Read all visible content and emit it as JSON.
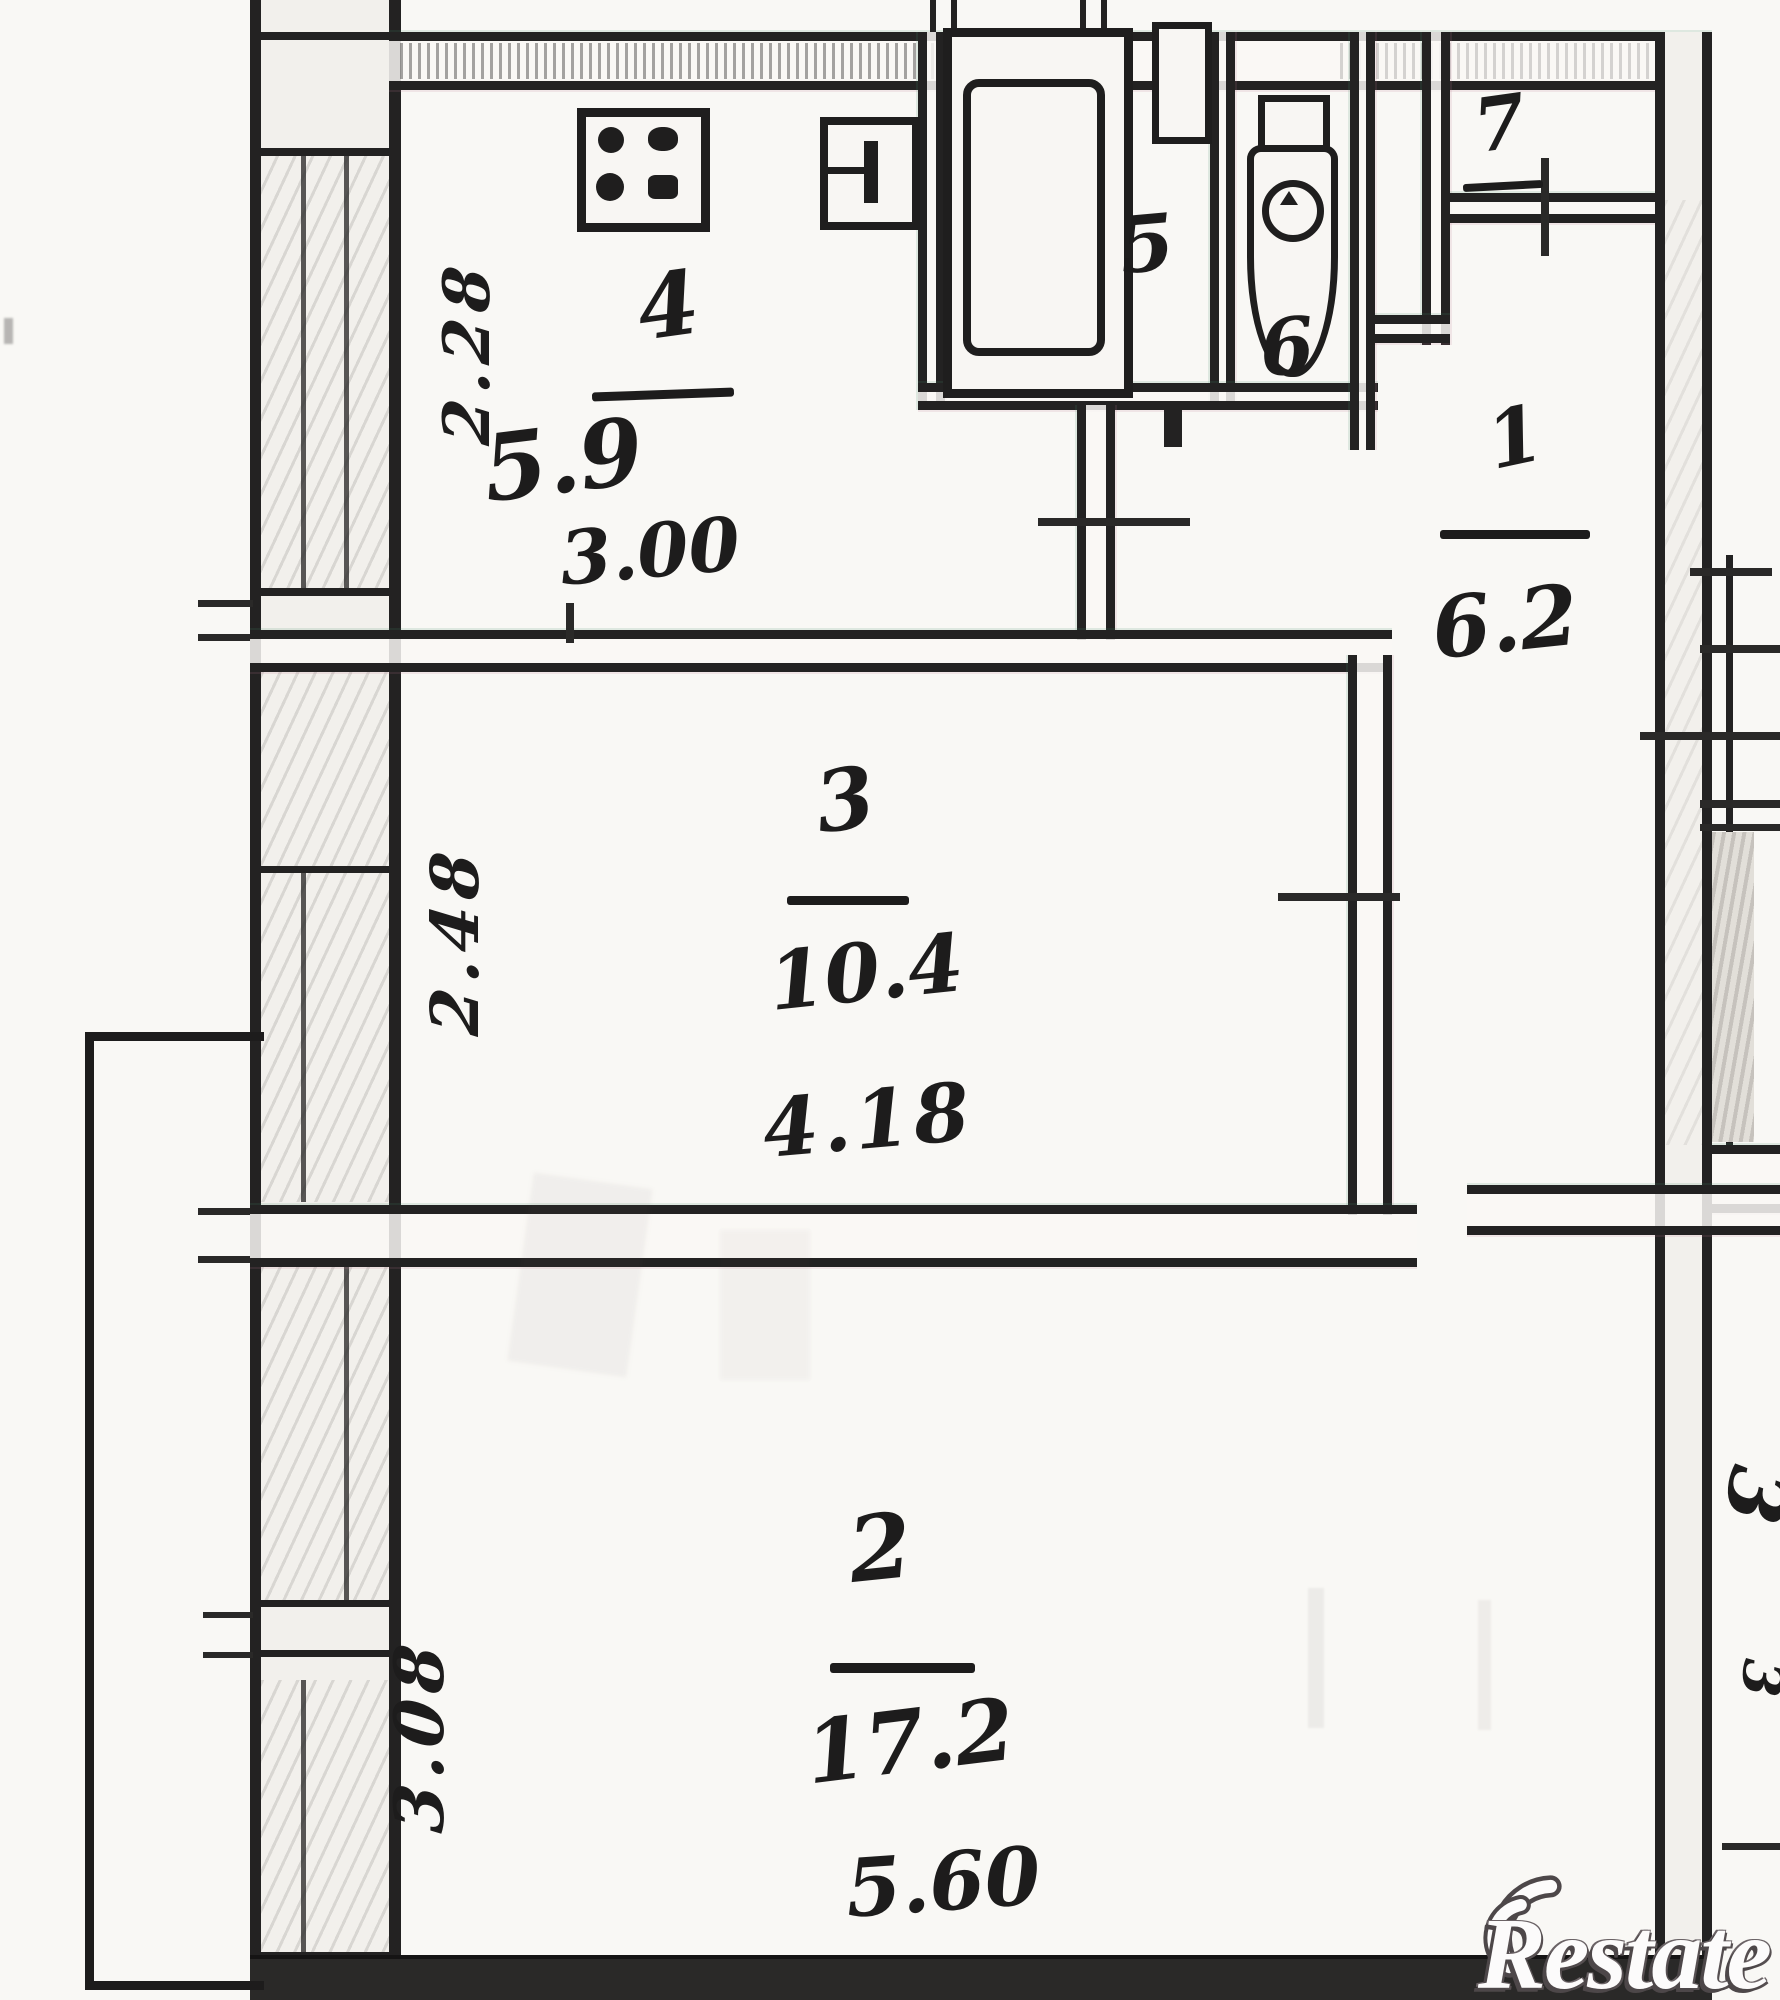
{
  "plan": {
    "kitchen": {
      "number": "4",
      "area": "5.9",
      "width_m": "3.00",
      "depth_m": "2.28"
    },
    "room3": {
      "number": "3",
      "area": "10.4",
      "width_m": "4.18",
      "depth_m": "2.48"
    },
    "room2": {
      "number": "2",
      "area": "17.2",
      "width_m": "5.60",
      "depth_m": "3.08"
    },
    "hall": {
      "number": "1",
      "area": "6.2"
    },
    "bath": {
      "number": "5"
    },
    "wc": {
      "number": "6"
    },
    "closet": {
      "number": "7"
    },
    "edge_marks": {
      "upper": "3",
      "lower": "3"
    }
  },
  "watermark": {
    "brand": "Restate"
  }
}
